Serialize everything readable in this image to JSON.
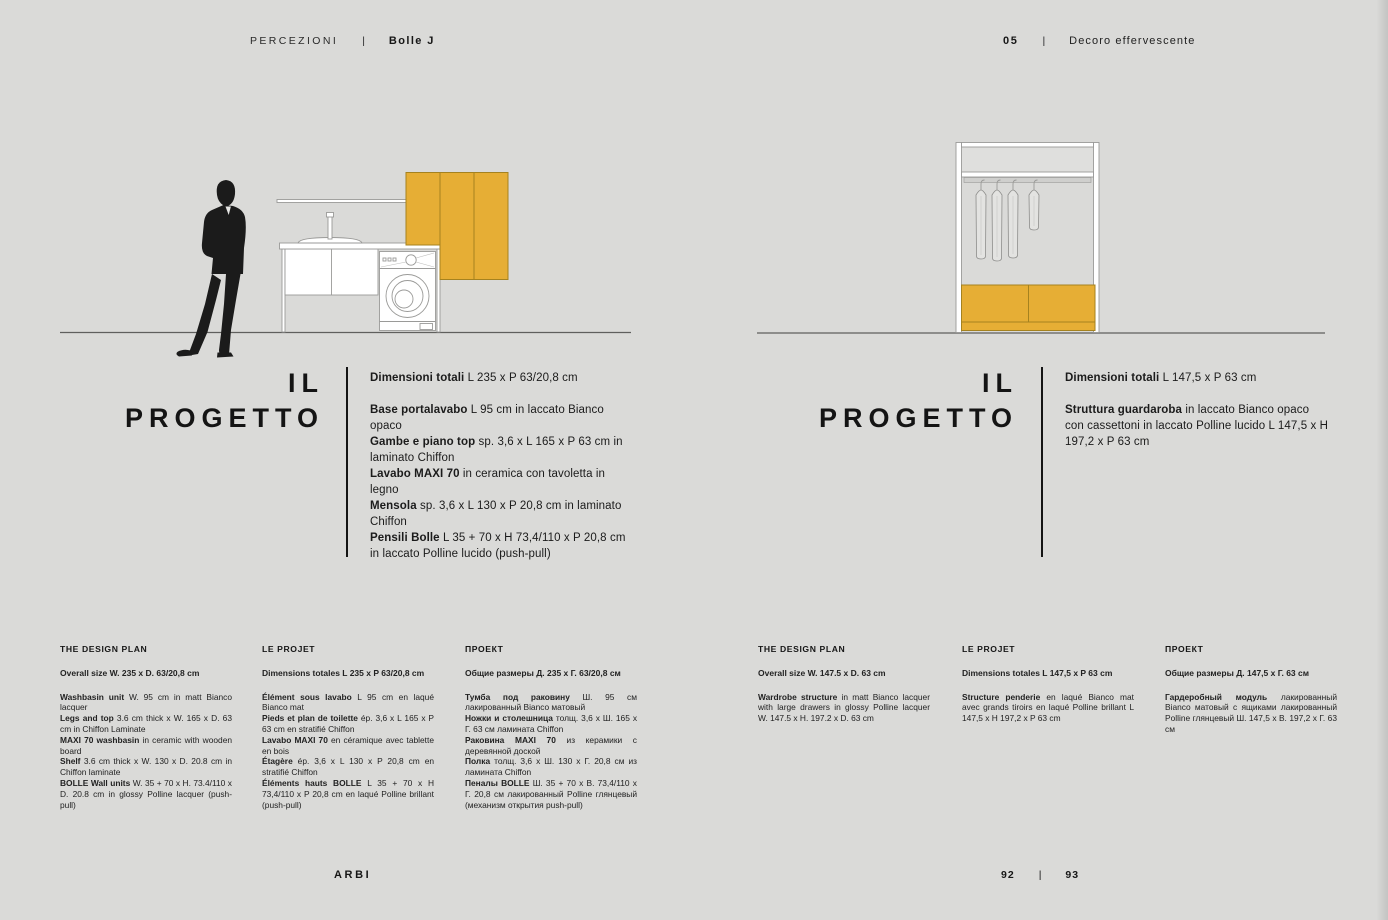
{
  "colors": {
    "background": "#dadad8",
    "accent": "#e6ae35",
    "ink": "#161616",
    "line": "#9a9a98"
  },
  "header": {
    "left": {
      "collection": "PERCEZIONI",
      "separator": "|",
      "model": "Bolle J"
    },
    "right": {
      "number": "05",
      "separator": "|",
      "chapter": "Decoro effervescente"
    }
  },
  "left_page": {
    "section_title": {
      "line1": "IL",
      "line2": "PROGETTO"
    },
    "spec": {
      "total_label": "Dimensioni totali",
      "total_text": "L 235 x P 63/20,8 cm",
      "items": [
        {
          "label": "Base portalavabo",
          "text": "L 95 cm in laccato Bianco opaco"
        },
        {
          "label": "Gambe e piano top",
          "text": "sp. 3,6 x L 165 x P 63 cm in laminato Chiffon"
        },
        {
          "label": "Lavabo MAXI 70",
          "text": "in ceramica con tavoletta in legno"
        },
        {
          "label": "Mensola",
          "text": "sp. 3,6 x L 130 x P 20,8 cm in laminato Chiffon"
        },
        {
          "label": "Pensili Bolle",
          "text": "L 35 + 70 x H 73,4/110 x P 20,8 cm in laccato Polline lucido (push-pull)"
        }
      ]
    },
    "columns": [
      {
        "heading": "THE DESIGN PLAN",
        "size": "Overall size W. 235 x D. 63/20,8 cm",
        "items": [
          {
            "label": "Washbasin unit",
            "text": "W. 95 cm in matt Bianco lacquer"
          },
          {
            "label": "Legs and top",
            "text": "3.6 cm thick x W. 165 x D. 63 cm in Chiffon Laminate"
          },
          {
            "label": "MAXI 70 washbasin",
            "text": "in ceramic with wooden board"
          },
          {
            "label": "Shelf",
            "text": "3.6 cm thick x W. 130 x D. 20.8 cm in Chiffon laminate"
          },
          {
            "label": "BOLLE Wall units",
            "text": "W. 35 + 70 x H. 73.4/110 x D. 20.8 cm in glossy Polline lacquer (push-pull)"
          }
        ]
      },
      {
        "heading": "LE PROJET",
        "size": "Dimensions totales L 235 x P 63/20,8 cm",
        "items": [
          {
            "label": "Élément sous lavabo",
            "text": "L 95 cm en laqué Bianco mat"
          },
          {
            "label": "Pieds et plan de toilette",
            "text": "ép. 3,6 x L 165 x P 63 cm en stratifié Chiffon"
          },
          {
            "label": "Lavabo MAXI 70",
            "text": "en céramique avec tablette en bois"
          },
          {
            "label": "Étagère",
            "text": "ép. 3,6 x L 130 x P 20,8 cm en stratifié Chiffon"
          },
          {
            "label": "Éléments hauts BOLLE",
            "text": "L 35 + 70 x H 73,4/110 x P 20,8 cm en laqué Polline brillant (push-pull)"
          }
        ]
      },
      {
        "heading": "ПРОЕКТ",
        "size": "Общие размеры Д. 235 x Г. 63/20,8 см",
        "items": [
          {
            "label": "Тумба под раковину",
            "text": "Ш. 95 см лакированный Bianco матовый"
          },
          {
            "label": "Ножки и столешница",
            "text": "толщ. 3,6 x Ш. 165 x Г. 63 см ламината Chiffon"
          },
          {
            "label": "Раковина MAXI 70",
            "text": "из керамики с деревянной доской"
          },
          {
            "label": "Полка",
            "text": "толщ. 3,6 x Ш. 130 x Г. 20,8 см из ламината Chiffon"
          },
          {
            "label": "Пеналы BOLLE",
            "text": "Ш. 35 + 70 x В. 73,4/110 x Г. 20,8 см лакированный Polline глянцевый (механизм открытия push-pull)"
          }
        ]
      }
    ]
  },
  "right_page": {
    "section_title": {
      "line1": "IL",
      "line2": "PROGETTO"
    },
    "spec": {
      "total_label": "Dimensioni totali",
      "total_text": "L 147,5 x P 63 cm",
      "items": [
        {
          "label": "Struttura guardaroba",
          "text": "in laccato Bianco opaco con cassettoni in laccato Polline lucido L 147,5 x H 197,2 x P 63 cm"
        }
      ]
    },
    "columns": [
      {
        "heading": "THE DESIGN PLAN",
        "size": "Overall size W. 147.5 x D. 63 cm",
        "items": [
          {
            "label": "Wardrobe structure",
            "text": "in matt Bianco lacquer with large drawers in glossy Polline lacquer W. 147.5 x H. 197.2 x D. 63 cm"
          }
        ]
      },
      {
        "heading": "LE PROJET",
        "size": "Dimensions totales L 147,5 x P 63 cm",
        "items": [
          {
            "label": "Structure penderie",
            "text": "en laqué Bianco mat avec grands tiroirs en laqué Polline brillant L 147,5 x H 197,2 x P 63 cm"
          }
        ]
      },
      {
        "heading": "ПРОЕКТ",
        "size": "Общие размеры Д. 147,5 x Г. 63 см",
        "items": [
          {
            "label": "Гардеробный модуль",
            "text": "лакированный Bianco матовый с ящиками лакированный Polline глянцевый Ш. 147,5 x В. 197,2 x Г. 63 см"
          }
        ]
      }
    ]
  },
  "footer": {
    "brand": "ARBI",
    "page_left": "92",
    "separator": "|",
    "page_right": "93"
  }
}
